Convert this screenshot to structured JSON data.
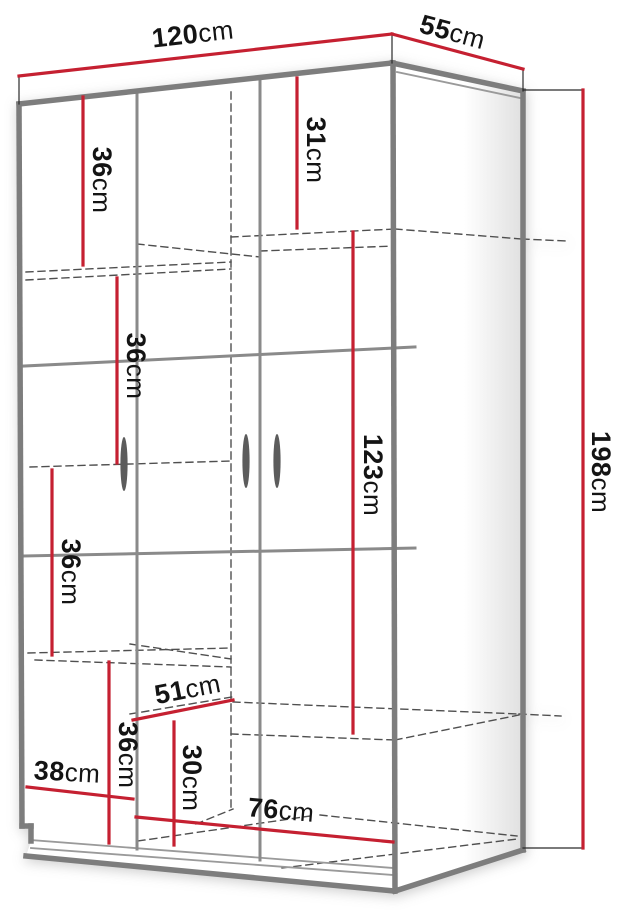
{
  "page": {
    "background": "#ffffff"
  },
  "drawing": {
    "type": "furniture-dimension-diagram",
    "subject": "three-door-wardrobe",
    "canvas": {
      "width": 620,
      "height": 910
    },
    "colors": {
      "dimension_red": "#c52031",
      "edge_gray": "#7d7d7d",
      "seam_gray": "#8a8a8a",
      "thin_gray": "#9a9a9a",
      "dash_gray": "#4f4f4f",
      "witness_dark": "#2a2a2a",
      "handle_gray": "#5c5c5c",
      "text_black": "#141414",
      "panel_shade": "#e2e2e2",
      "background": "#ffffff"
    },
    "font": {
      "label_size": 27,
      "unit_size": 26
    },
    "dimensions": [
      {
        "id": "width-top",
        "value": "120",
        "unit": "cm",
        "line": [
          19,
          76,
          392,
          34
        ],
        "label": {
          "x": 193,
          "y": 36,
          "rotate": -6.5
        }
      },
      {
        "id": "depth-top",
        "value": "55",
        "unit": "cm",
        "line": [
          392,
          34,
          523,
          69
        ],
        "label": {
          "x": 452,
          "y": 34,
          "rotate": 15
        }
      },
      {
        "id": "height-right",
        "value": "198",
        "unit": "cm",
        "line": [
          583,
          90,
          583,
          848
        ],
        "label": {
          "x": 599,
          "y": 472,
          "rotate": 90
        }
      },
      {
        "id": "shelf-top-right",
        "value": "31",
        "unit": "cm",
        "line": [
          297,
          78,
          297,
          228
        ],
        "label": {
          "x": 314,
          "y": 150,
          "rotate": 90
        }
      },
      {
        "id": "shelf-top-left",
        "value": "36",
        "unit": "cm",
        "line": [
          83,
          97,
          83,
          265
        ],
        "label": {
          "x": 100,
          "y": 180,
          "rotate": 90
        }
      },
      {
        "id": "shelf-left-2",
        "value": "36",
        "unit": "cm",
        "line": [
          117,
          278,
          117,
          463
        ],
        "label": {
          "x": 134,
          "y": 366,
          "rotate": 90
        }
      },
      {
        "id": "shelf-left-3",
        "value": "36",
        "unit": "cm",
        "line": [
          52,
          470,
          52,
          655
        ],
        "label": {
          "x": 69,
          "y": 572,
          "rotate": 90
        }
      },
      {
        "id": "shelf-left-4",
        "value": "36",
        "unit": "cm",
        "line": [
          109,
          662,
          109,
          843
        ],
        "label": {
          "x": 126,
          "y": 755,
          "rotate": 90
        }
      },
      {
        "id": "hanging-space",
        "value": "123",
        "unit": "cm",
        "line": [
          353,
          232,
          353,
          733
        ],
        "label": {
          "x": 371,
          "y": 475,
          "rotate": 90
        }
      },
      {
        "id": "interior-depth",
        "value": "51",
        "unit": "cm",
        "line": [
          133,
          720,
          233,
          700
        ],
        "label": {
          "x": 188,
          "y": 691,
          "rotate": -11
        }
      },
      {
        "id": "bottom-left-width",
        "value": "38",
        "unit": "cm",
        "line": [
          27,
          787,
          133,
          799
        ],
        "label": {
          "x": 67,
          "y": 774,
          "rotate": 3
        }
      },
      {
        "id": "bottom-height",
        "value": "30",
        "unit": "cm",
        "line": [
          174,
          722,
          174,
          845
        ],
        "label": {
          "x": 190,
          "y": 778,
          "rotate": 90
        }
      },
      {
        "id": "bottom-right-width",
        "value": "76",
        "unit": "cm",
        "line": [
          136,
          817,
          393,
          842
        ],
        "label": {
          "x": 281,
          "y": 812,
          "rotate": 5
        }
      }
    ],
    "witness_lines": [
      [
        19,
        76,
        19,
        104
      ],
      [
        392,
        34,
        392,
        63
      ],
      [
        523,
        69,
        523,
        91
      ],
      [
        523,
        90,
        583,
        90
      ],
      [
        523,
        848,
        583,
        848
      ]
    ],
    "structure": {
      "side_panel_polygon": [
        392,
        63,
        523,
        91,
        523,
        850,
        395,
        891
      ],
      "thick_edges": [
        [
          19,
          104,
          392,
          63
        ],
        [
          19,
          104,
          22,
          826
        ],
        [
          22,
          826,
          31,
          826
        ],
        [
          31,
          826,
          31,
          841
        ],
        [
          26,
          856,
          394,
          891
        ],
        [
          393,
          63,
          395,
          891
        ],
        [
          392,
          63,
          523,
          91
        ],
        [
          523,
          91,
          523,
          850
        ],
        [
          395,
          891,
          523,
          850
        ]
      ],
      "thin_edges": [
        [
          397,
          72,
          520,
          98
        ],
        [
          31,
          840,
          393,
          868
        ],
        [
          31,
          848,
          393,
          875
        ]
      ],
      "seams": [
        [
          137,
          91,
          137,
          849
        ],
        [
          260,
          78,
          260,
          860
        ],
        [
          24,
          366,
          415,
          347
        ],
        [
          24,
          556,
          415,
          548
        ]
      ],
      "dashed": [
        [
          231,
          92,
          231,
          810
        ],
        [
          26,
          272,
          231,
          262
        ],
        [
          26,
          280,
          231,
          269
        ],
        [
          137,
          244,
          260,
          257
        ],
        [
          231,
          237,
          395,
          229
        ],
        [
          260,
          251,
          395,
          246
        ],
        [
          395,
          229,
          522,
          239
        ],
        [
          522,
          239,
          566,
          241
        ],
        [
          30,
          467,
          231,
          461
        ],
        [
          28,
          653,
          231,
          648
        ],
        [
          130,
          644,
          231,
          659
        ],
        [
          35,
          660,
          231,
          667
        ],
        [
          130,
          714,
          232,
          697
        ],
        [
          233,
          702,
          519,
          714
        ],
        [
          519,
          714,
          561,
          716
        ],
        [
          231,
          734,
          395,
          740
        ],
        [
          395,
          740,
          519,
          715
        ],
        [
          196,
          824,
          233,
          809
        ],
        [
          138,
          841,
          310,
          816
        ],
        [
          320,
          815,
          517,
          836
        ],
        [
          282,
          868,
          517,
          839
        ]
      ],
      "handles": [
        {
          "cx": 124,
          "cy": 464,
          "rx": 3.6,
          "ry": 27
        },
        {
          "cx": 246,
          "cy": 461,
          "rx": 3.6,
          "ry": 27
        },
        {
          "cx": 277,
          "cy": 461,
          "rx": 3.6,
          "ry": 27
        }
      ]
    }
  }
}
